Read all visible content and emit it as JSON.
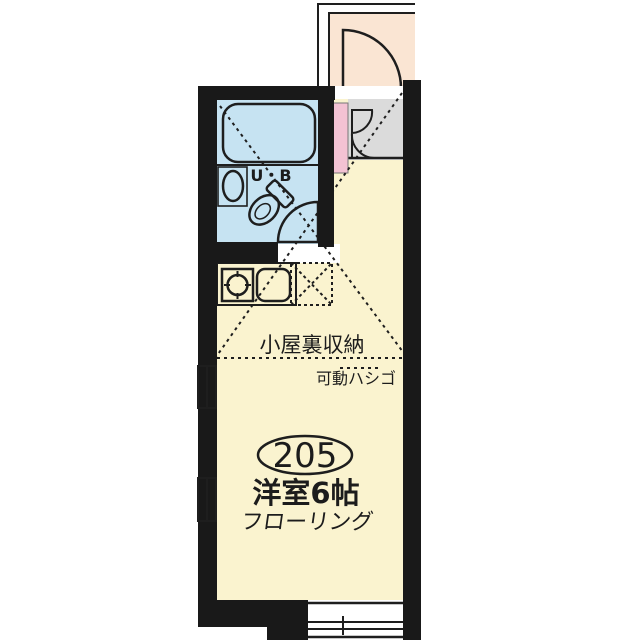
{
  "unit": {
    "room_number": "205",
    "room_type": "洋室6帖",
    "flooring": "フローリング",
    "bath_label": "U・B",
    "attic_label": "小屋裏収納",
    "ladder_label": "可動ハシゴ"
  },
  "colors": {
    "wall": "#191919",
    "room": "#FAF3CF",
    "wet_area": "#C6E3F2",
    "entrance": "#DBDBDB",
    "corridor": "#FAE5D3",
    "accent_pink": "#F3C2D3",
    "line": "#1E1E1E",
    "paper": "#FFFFFF"
  }
}
